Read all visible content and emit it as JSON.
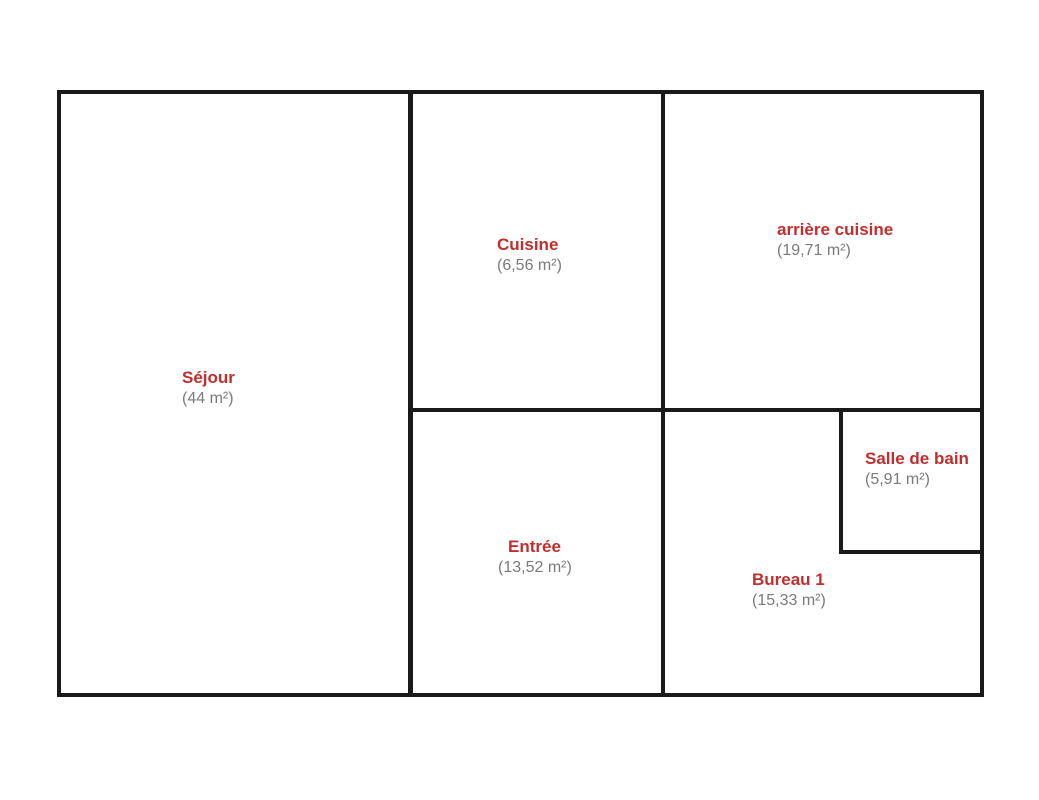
{
  "title": "Plan d'appartement",
  "colors": {
    "background": "#ffffff",
    "wall": "#1a1a1a",
    "room_name": "#c22e2e",
    "room_area": "#7a7a7a"
  },
  "rooms": [
    {
      "id": "sejour",
      "name": "Séjour",
      "area": "(44 m²)"
    },
    {
      "id": "cuisine",
      "name": "Cuisine",
      "area": "(6,56 m²)"
    },
    {
      "id": "arriere-cuisine",
      "name": "arrière cuisine",
      "area": "(19,71 m²)"
    },
    {
      "id": "entree",
      "name": "Entrée",
      "area": "(13,52 m²)"
    },
    {
      "id": "bureau",
      "name": "Bureau 1",
      "area": "(15,33 m²)"
    },
    {
      "id": "salle-de-bain",
      "name": "Salle de bain",
      "area": "(5,91 m²)"
    }
  ]
}
